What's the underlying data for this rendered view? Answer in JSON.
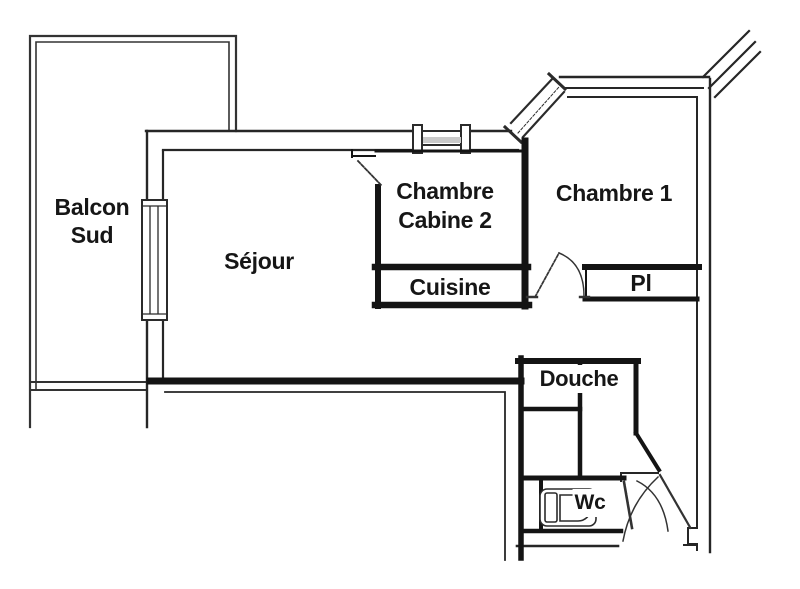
{
  "plan": {
    "type": "apartment-floor-plan",
    "colors": {
      "background": "#ffffff",
      "walls_thick": "#141414",
      "walls_thin": "#2b2b2b",
      "text": "#161616"
    },
    "rooms": {
      "balcon_sud": {
        "line1": "Balcon",
        "line2": "Sud"
      },
      "sejour": {
        "label": "Séjour"
      },
      "chambre_cabine_2": {
        "line1": "Chambre",
        "line2": "Cabine 2"
      },
      "cuisine": {
        "label": "Cuisine"
      },
      "chambre_1": {
        "label": "Chambre 1"
      },
      "placard": {
        "label": "Pl"
      },
      "douche": {
        "label": "Douche"
      },
      "wc": {
        "label": "Wc"
      }
    }
  }
}
